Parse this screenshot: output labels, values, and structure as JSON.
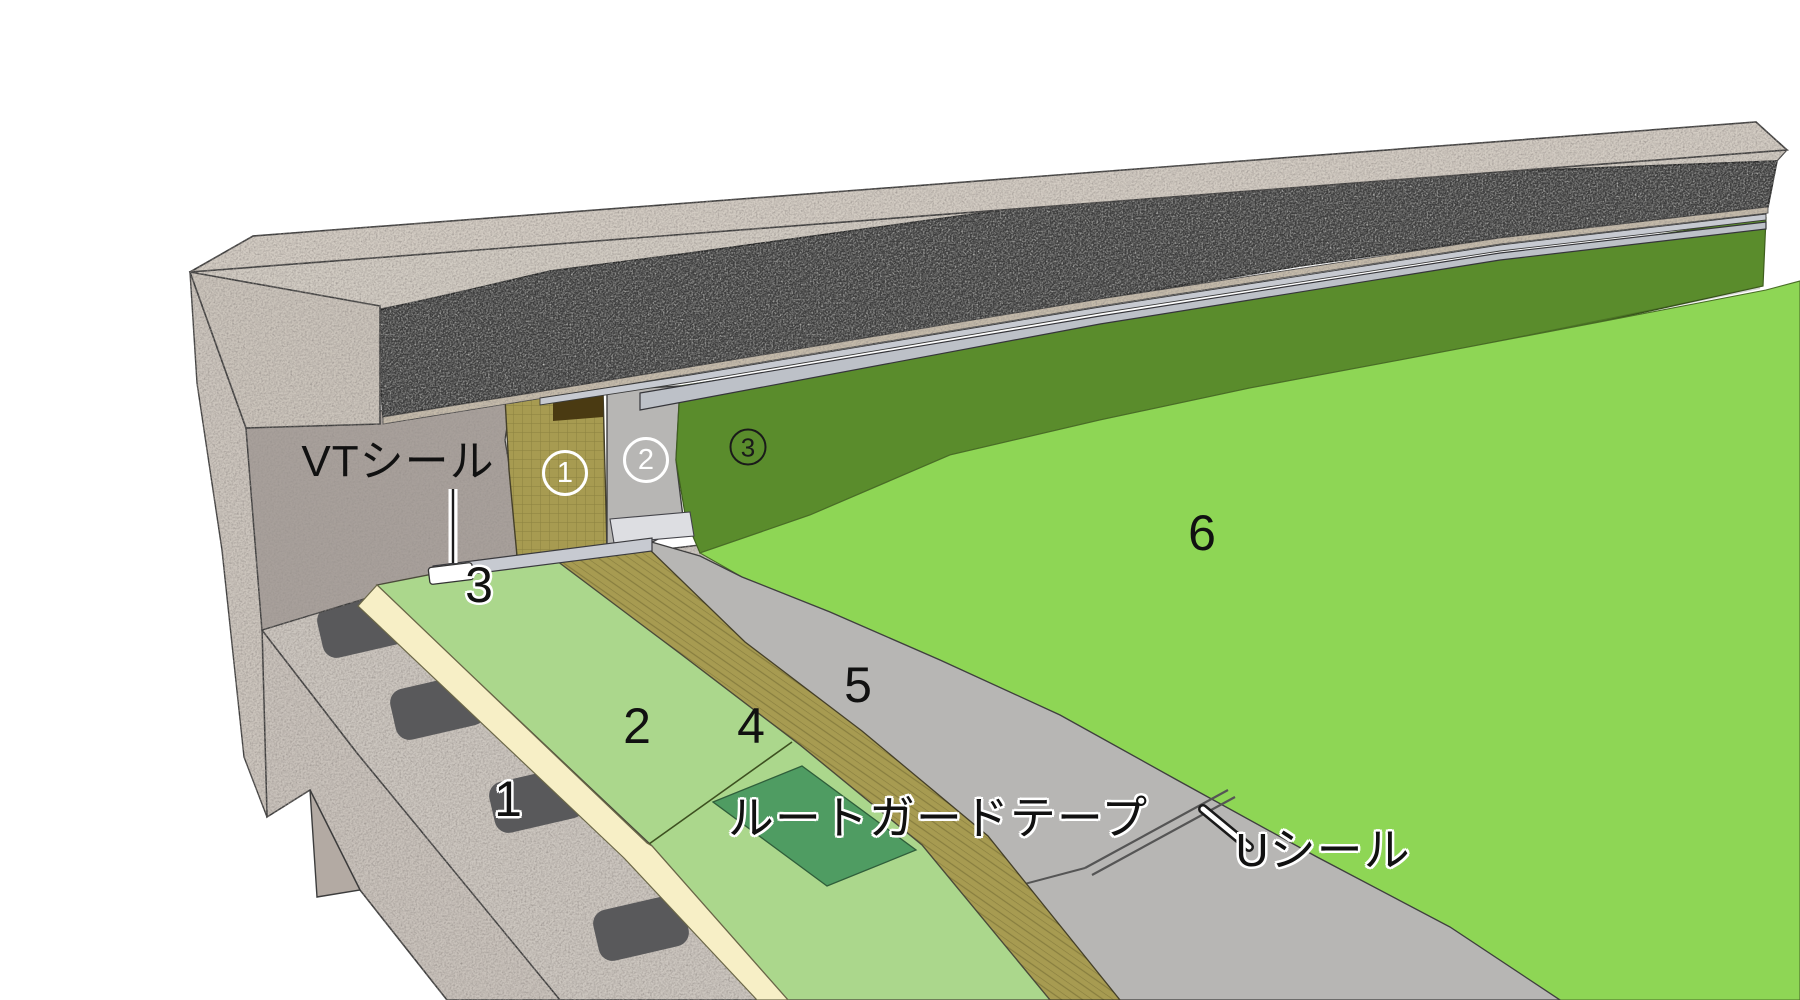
{
  "diagram": {
    "description": "roof-parapet-waterproofing-layer-detail",
    "labels": {
      "vt_seal": "VTシール",
      "vt_seal_num": "3",
      "wall_layer_1": "1",
      "wall_layer_2": "2",
      "wall_layer_3": "3",
      "floor_layer_1": "1",
      "floor_layer_2": "2",
      "floor_layer_4": "4",
      "floor_layer_5": "5",
      "floor_layer_6": "6",
      "root_guard_tape": "ルートガードテープ",
      "u_seal": "Uシール"
    },
    "colors": {
      "background": "#ffffff",
      "concrete_light": "#d3ccc3",
      "concrete_cut": "#cbc4bb",
      "concrete_deck": "#ccc6bf",
      "concrete_wall": "#a8a09b",
      "insulation_dark": "#3d3d3d",
      "metal_flashing": "#c7cad1",
      "base_sheet_olive": "#a79b51",
      "sheet_gray": "#b7b6b4",
      "membrane_dark_green": "#5a8c2c",
      "membrane_bright_green": "#8ed655",
      "board_light_green": "#abd78c",
      "board_edge_cream": "#f7efc6",
      "tape_green": "#4f9c62",
      "adhesive_dark": "#59595b",
      "seal_white": "#ffffff"
    }
  }
}
